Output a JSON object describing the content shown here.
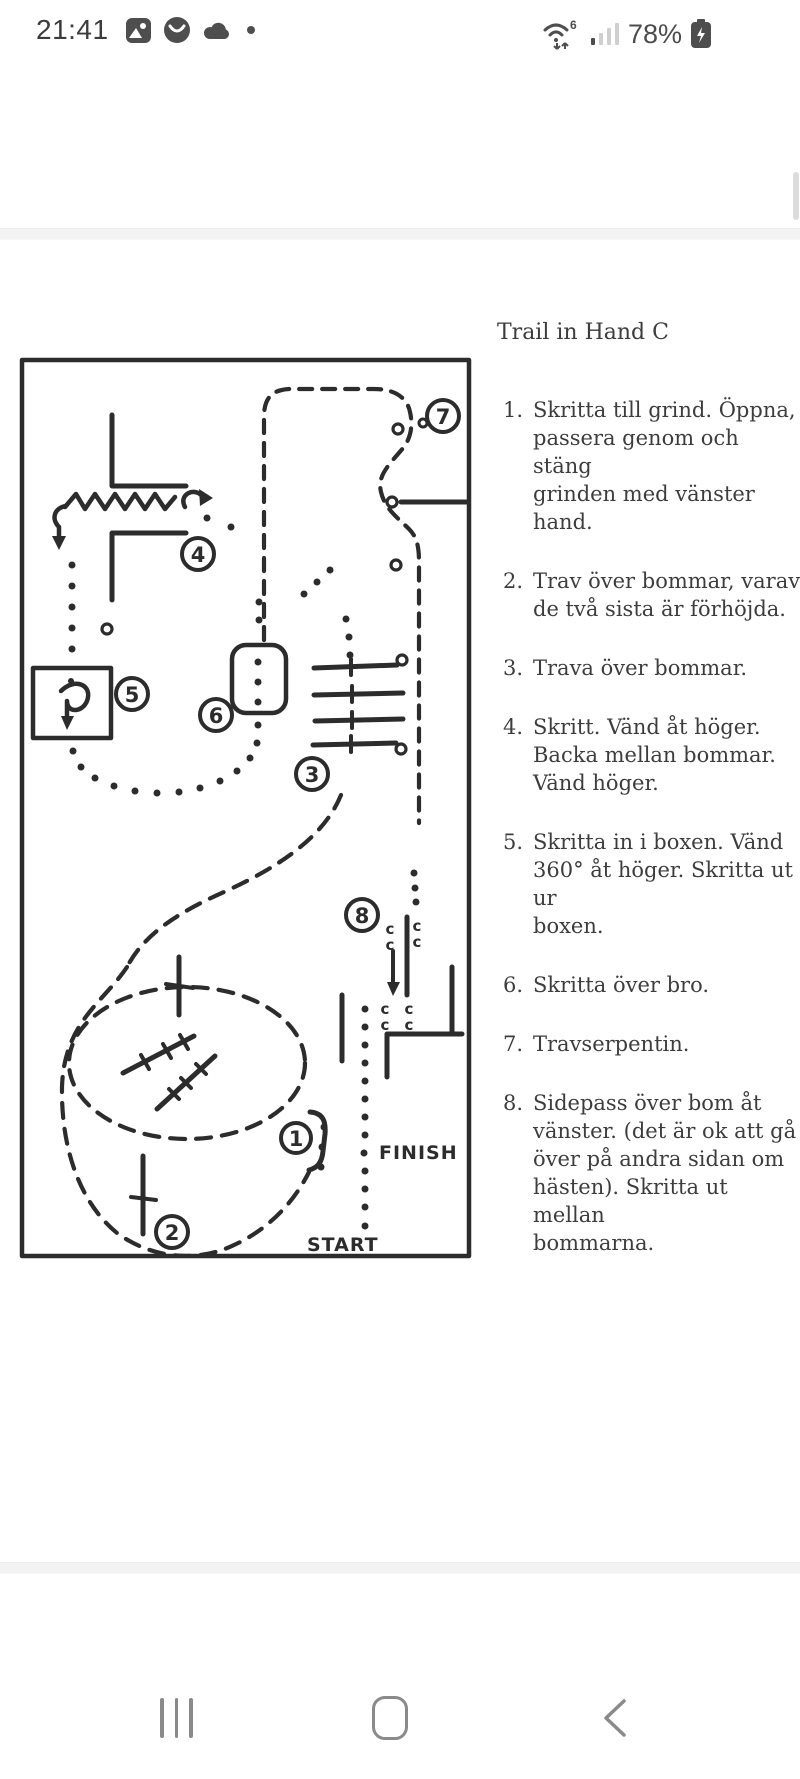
{
  "status_bar": {
    "time": "21:41",
    "battery_percent": "78%",
    "wifi_generation": "6",
    "icons": [
      "gallery-icon",
      "app-circle-icon",
      "cloud-icon",
      "notification-dot",
      "wifi-icon",
      "signal-bars-icon",
      "battery-charging-icon"
    ]
  },
  "document": {
    "title": "Trail in Hand C",
    "instructions": [
      {
        "num": "1.",
        "lines": [
          "Skritta till grind. Öppna,",
          "passera genom och stäng",
          "grinden med vänster hand."
        ]
      },
      {
        "num": "2.",
        "lines": [
          "Trav över bommar, varav",
          "de två sista är förhöjda."
        ]
      },
      {
        "num": "3.",
        "lines": [
          "Trava över bommar."
        ]
      },
      {
        "num": "4.",
        "lines": [
          "Skritt. Vänd åt höger.",
          "Backa mellan bommar.",
          "Vänd höger."
        ]
      },
      {
        "num": "5.",
        "lines": [
          "Skritta in i boxen. Vänd",
          "360° åt höger. Skritta ut ur",
          "boxen."
        ]
      },
      {
        "num": "6.",
        "lines": [
          "Skritta över bro."
        ]
      },
      {
        "num": "7.",
        "lines": [
          "Travserpentin."
        ]
      },
      {
        "num": "8.",
        "lines": [
          "Sidepass över bom åt",
          "vänster. (det är ok att gå",
          "över på andra sidan om",
          "hästen). Skritta ut mellan",
          "bommarna."
        ]
      }
    ],
    "diagram": {
      "start_label": "START",
      "finish_label": "FINISH",
      "stations": [
        "1",
        "2",
        "3",
        "4",
        "5",
        "6",
        "7",
        "8"
      ],
      "pole_letters": "c"
    }
  },
  "nav_bar": {
    "icons": [
      "recents-icon",
      "home-icon",
      "back-icon"
    ]
  },
  "colors": {
    "ink": "#2c2c2c",
    "text": "#3d3d3d",
    "status_icon": "#4e4e4e",
    "nav_icon": "#8a8a8a",
    "separator": "#f3f3f3"
  }
}
